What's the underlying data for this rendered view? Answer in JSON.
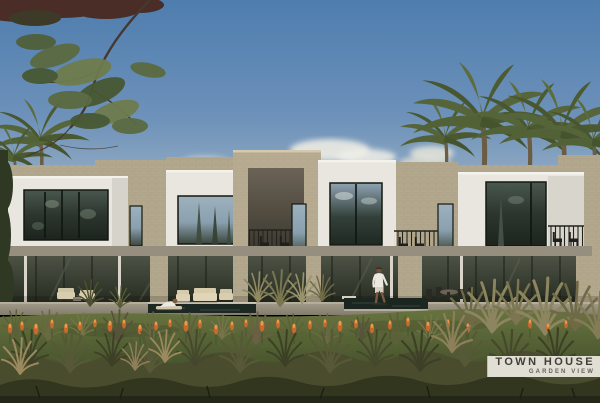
{
  "badge": {
    "title": "TOWN HOUSE",
    "subtitle": "GARDEN VIEW"
  },
  "palette": {
    "sky_top": "#4e7dae",
    "sky_horizon": "#b6c4ce",
    "facade_white": "#e9e6df",
    "stone_beige": "#b3a88e",
    "window_glass_dark": "#2c352e",
    "lawn_green": "#5b683a",
    "flower_orange": "#cd6f2e",
    "badge_background": "#edeae1",
    "badge_text": "#3f3e39"
  }
}
